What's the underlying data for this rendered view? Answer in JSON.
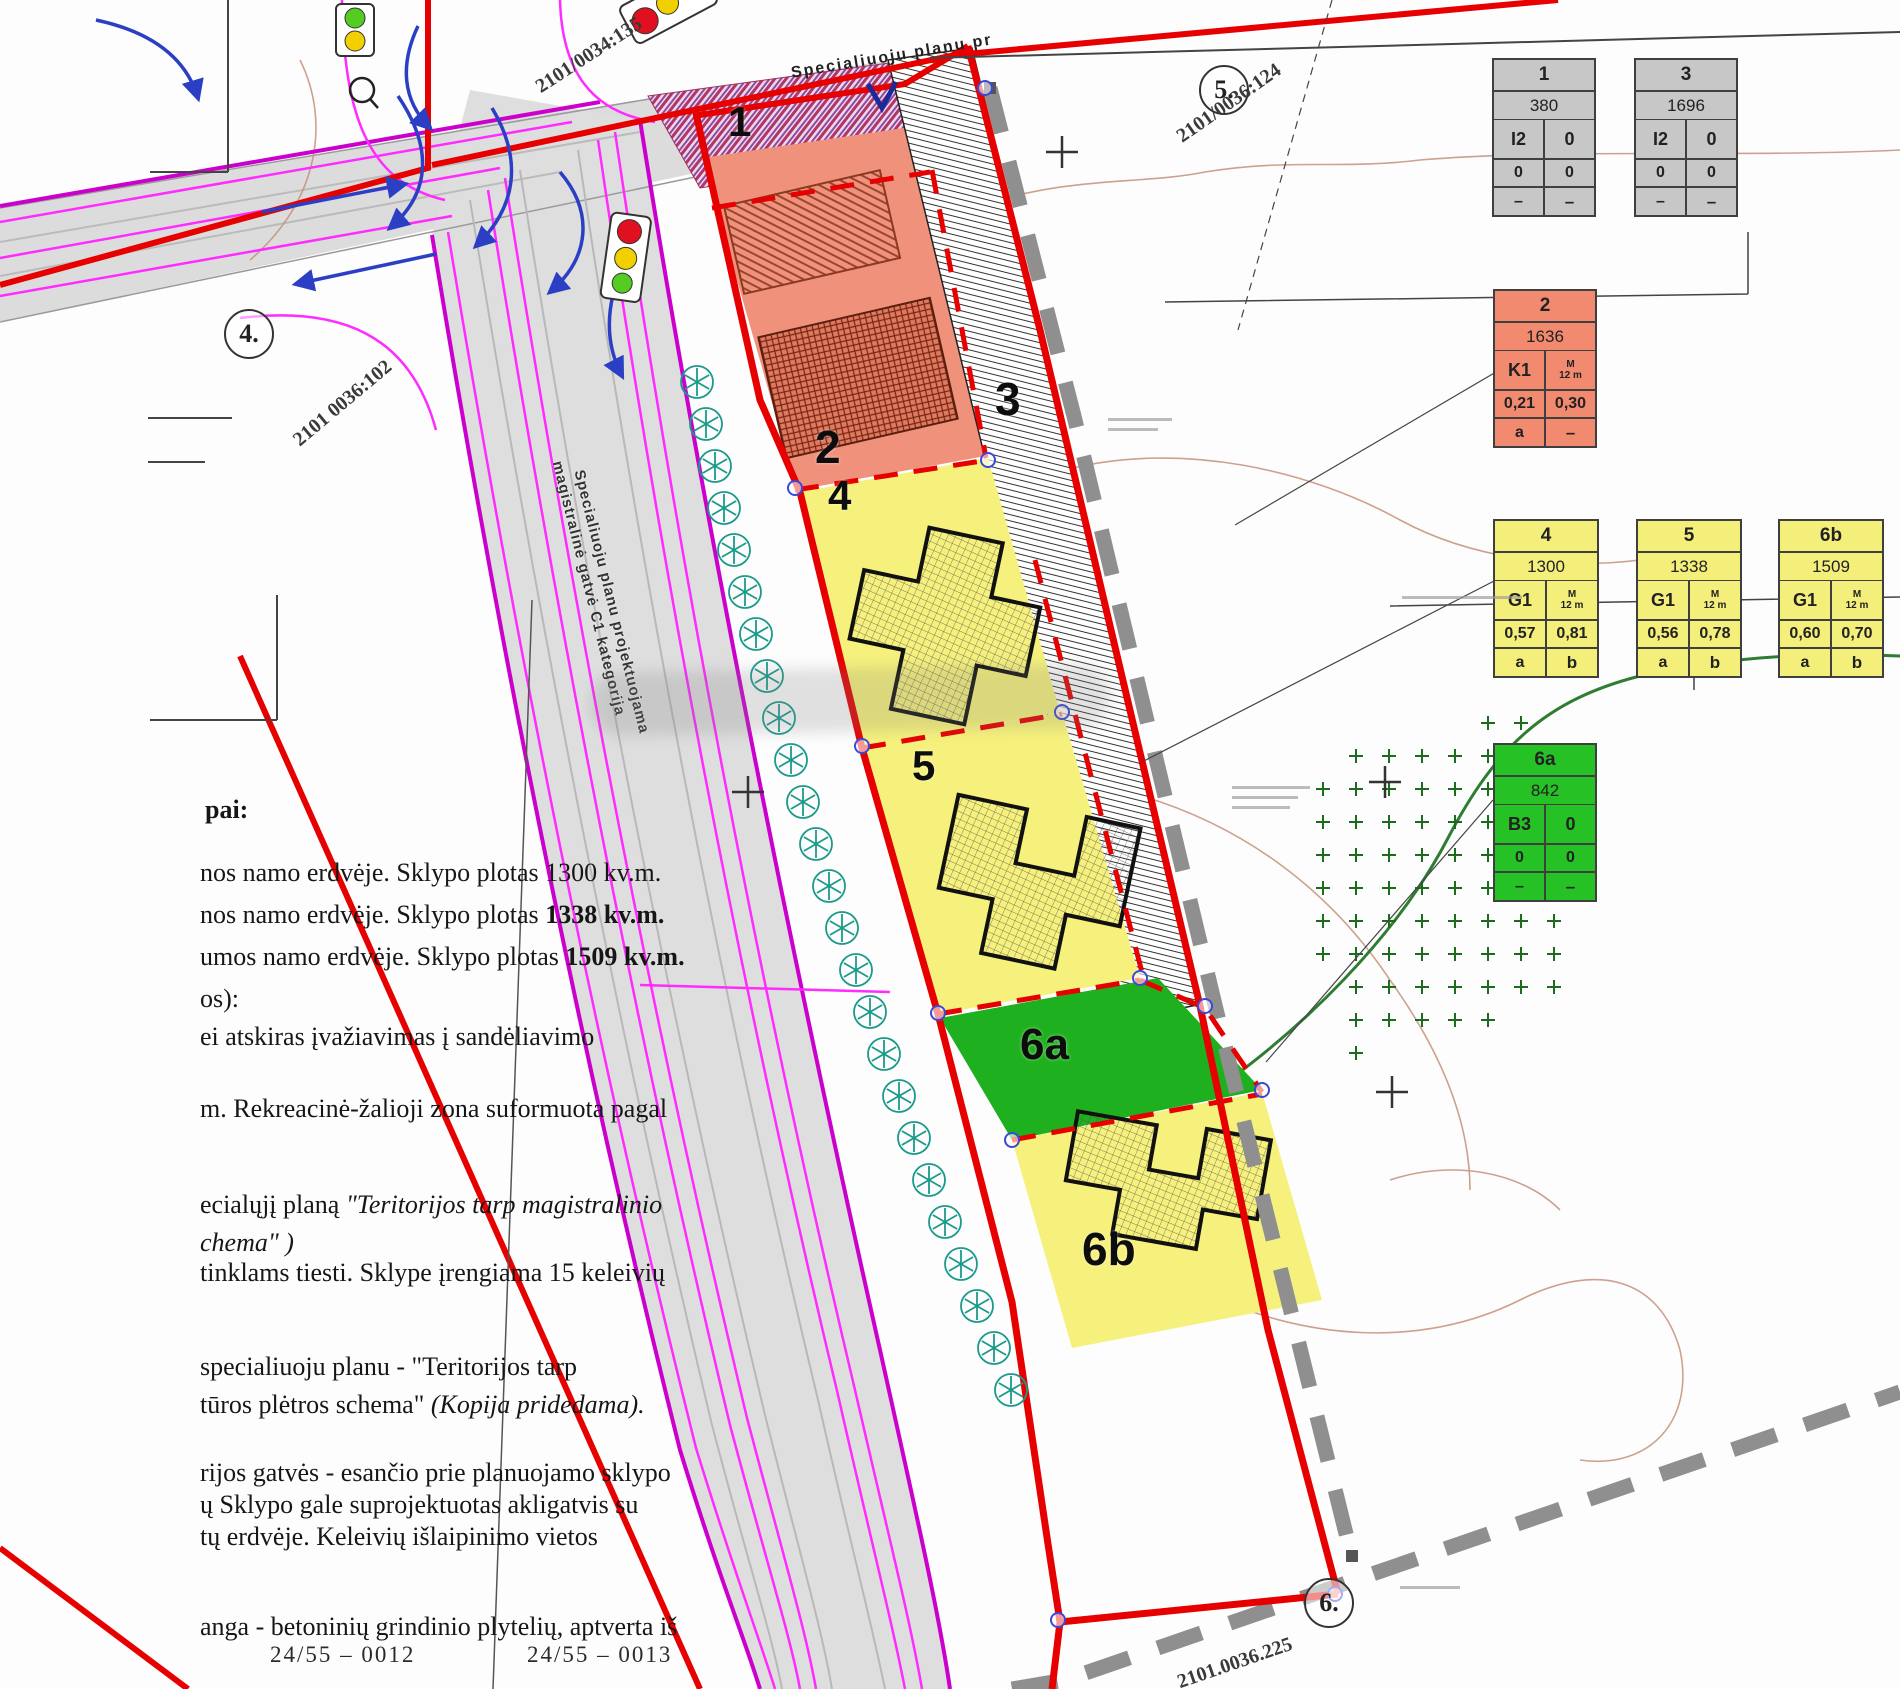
{
  "map": {
    "plot_labels": {
      "p1": "1",
      "p2": "2",
      "p3": "3",
      "p4": "4",
      "p5": "5",
      "p6a": "6a",
      "p6b": "6b"
    },
    "circled_labels": {
      "c4": "4.",
      "c5": "5.",
      "c6": "6."
    },
    "parcel_labels": {
      "top_left": "2101/0034:135",
      "top_right": "2101/0036:124",
      "left": "2101 0036:102",
      "bottom_right": "2101.0036.225"
    },
    "road_labels": {
      "top": "Specialiuoju planu pr",
      "street_line1": "Specialiuoju planu projektuojama",
      "street_line2": "magistralinė gatvė C1 kategorija"
    },
    "accent_colors": {
      "boundary_red": "#e60000",
      "utility_magenta": "#ff2bff",
      "dashed_gray": "#8f8f8f",
      "tree_teal": "#1a9a8a",
      "green_zone": "#2e7d32"
    }
  },
  "tables": [
    {
      "num": "1",
      "x": 1492,
      "y": 58,
      "w": 104,
      "color": "#c7c7c7",
      "area": "380",
      "r3l": "I2",
      "r3r": "0",
      "sub": null,
      "r4l": "0",
      "r4r": "0",
      "r5l": "–",
      "r5r": "–"
    },
    {
      "num": "3",
      "x": 1634,
      "y": 58,
      "w": 104,
      "color": "#c7c7c7",
      "area": "1696",
      "r3l": "I2",
      "r3r": "0",
      "sub": null,
      "r4l": "0",
      "r4r": "0",
      "r5l": "–",
      "r5r": "–"
    },
    {
      "num": "2",
      "x": 1493,
      "y": 289,
      "w": 104,
      "color": "#f28a70",
      "area": "1636",
      "r3l": "K1",
      "r3r": null,
      "sub": [
        "M",
        "12 m"
      ],
      "r4l": "0,21",
      "r4r": "0,30",
      "r5l": "a",
      "r5r": "–"
    },
    {
      "num": "4",
      "x": 1493,
      "y": 519,
      "w": 106,
      "color": "#f4ef7b",
      "area": "1300",
      "r3l": "G1",
      "r3r": null,
      "sub": [
        "M",
        "12 m"
      ],
      "r4l": "0,57",
      "r4r": "0,81",
      "r5l": "a",
      "r5r": "b"
    },
    {
      "num": "5",
      "x": 1636,
      "y": 519,
      "w": 106,
      "color": "#f4ef7b",
      "area": "1338",
      "r3l": "G1",
      "r3r": null,
      "sub": [
        "M",
        "12 m"
      ],
      "r4l": "0,56",
      "r4r": "0,78",
      "r5l": "a",
      "r5r": "b"
    },
    {
      "num": "6b",
      "x": 1778,
      "y": 519,
      "w": 106,
      "color": "#f4ef7b",
      "area": "1509",
      "r3l": "G1",
      "r3r": null,
      "sub": [
        "M",
        "12 m"
      ],
      "r4l": "0,60",
      "r4r": "0,70",
      "r5l": "a",
      "r5r": "b"
    },
    {
      "num": "6a",
      "x": 1493,
      "y": 743,
      "w": 104,
      "color": "#25c125",
      "area": "842",
      "r3l": "B3",
      "r3r": "0",
      "sub": null,
      "r4l": "0",
      "r4r": "0",
      "r5l": "–",
      "r5r": "–"
    }
  ],
  "notes": {
    "heading": "pai:",
    "lines": [
      {
        "y": 858,
        "parts": [
          [
            "nos namo erdvėje. Sklypo plotas 1300 kv.m.",
            ""
          ]
        ]
      },
      {
        "y": 900,
        "parts": [
          [
            "nos namo erdvėje. Sklypo plotas ",
            ""
          ],
          [
            "1338 kv.m.",
            "b"
          ]
        ]
      },
      {
        "y": 942,
        "parts": [
          [
            "umos namo erdvėje. Sklypo plotas ",
            ""
          ],
          [
            "1509 kv.m.",
            "b"
          ]
        ]
      },
      {
        "y": 984,
        "parts": [
          [
            "os):",
            ""
          ]
        ]
      },
      {
        "y": 1022,
        "parts": [
          [
            "ei atskiras įvažiavimas į sandėliavimo",
            ""
          ]
        ]
      },
      {
        "y": 1094,
        "parts": [
          [
            "m. Rekreacinė-žalioji zona suformuota pagal",
            ""
          ]
        ]
      },
      {
        "y": 1190,
        "parts": [
          [
            "ecialųjį planą ",
            ""
          ],
          [
            "\"Teritorijos tarp magistralinio",
            "i"
          ]
        ]
      },
      {
        "y": 1228,
        "parts": [
          [
            "chema\" )",
            "i"
          ]
        ]
      },
      {
        "y": 1258,
        "parts": [
          [
            "tinklams tiesti. Sklype įrengiama 15 keleivių",
            ""
          ]
        ]
      },
      {
        "y": 1352,
        "parts": [
          [
            "specialiuoju planu - \"Teritorijos tarp",
            ""
          ]
        ]
      },
      {
        "y": 1390,
        "parts": [
          [
            "tūros plėtros schema\" ",
            ""
          ],
          [
            "(Kopija pridedama).",
            "i"
          ]
        ]
      },
      {
        "y": 1458,
        "parts": [
          [
            "rijos gatvės - esančio prie planuojamo sklypo",
            ""
          ]
        ]
      },
      {
        "y": 1490,
        "parts": [
          [
            "ų  Sklypo gale suprojektuotas akligatvis su",
            ""
          ]
        ]
      },
      {
        "y": 1522,
        "parts": [
          [
            "tų erdvėje. Keleivių išlaipinimo vietos",
            ""
          ]
        ]
      },
      {
        "y": 1612,
        "parts": [
          [
            "anga - betoninių grindinio plytelių, aptverta iš",
            ""
          ]
        ]
      }
    ]
  },
  "sheet": {
    "left": "24/55  –  0012",
    "right": "24/55  –  0013"
  }
}
